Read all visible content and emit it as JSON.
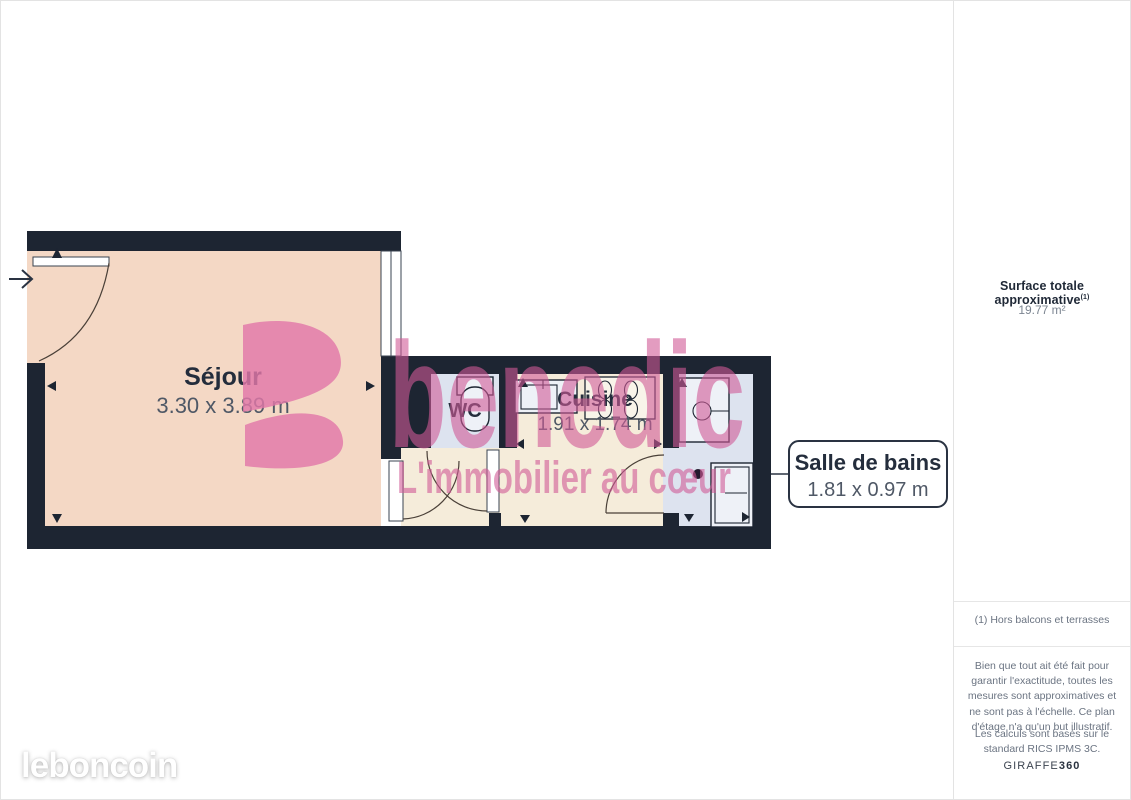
{
  "plan": {
    "rooms": {
      "sejour": {
        "name": "Séjour",
        "dims": "3.30 x 3.89 m"
      },
      "wc": {
        "name": "WC"
      },
      "cuisine": {
        "name": "Cuisine",
        "dims": "1.91 x 1.74 m"
      },
      "salle_de_bains": {
        "name": "Salle de bains",
        "dims": "1.81 x 0.97 m"
      }
    },
    "watermark": {
      "brand": "benedic",
      "tagline": "L'immobilier au cœur"
    }
  },
  "sidebar": {
    "surface_label": "Surface totale approximative",
    "surface_label_sup": "(1)",
    "surface_value": "19.77 m²",
    "footnote": "(1) Hors balcons et terrasses",
    "disclaimer": "Bien que tout ait été fait pour garantir l'exactitude, toutes les mesures sont approximatives et ne sont pas à l'échelle. Ce plan d'étage n'a qu'un but illustratif.",
    "standard_note": "Les calculs sont basés sur le standard RICS IPMS 3C.",
    "brand_name": "GIRAFFE",
    "brand_suffix": "360"
  },
  "footer": {
    "logo": "leboncoin"
  },
  "colors": {
    "wall": "#1d2532",
    "sejour": "#f4d8c5",
    "cream": "#f5ecda",
    "wet": "#dde3ef",
    "fixture": "#eef1f7",
    "pinkA": "rgba(208,90,150,0.60)",
    "logoPink": "rgba(226,120,168,0.82)",
    "text_dark": "#242d3c",
    "text_gray": "#4f5866",
    "border": "#e3e3e3"
  }
}
